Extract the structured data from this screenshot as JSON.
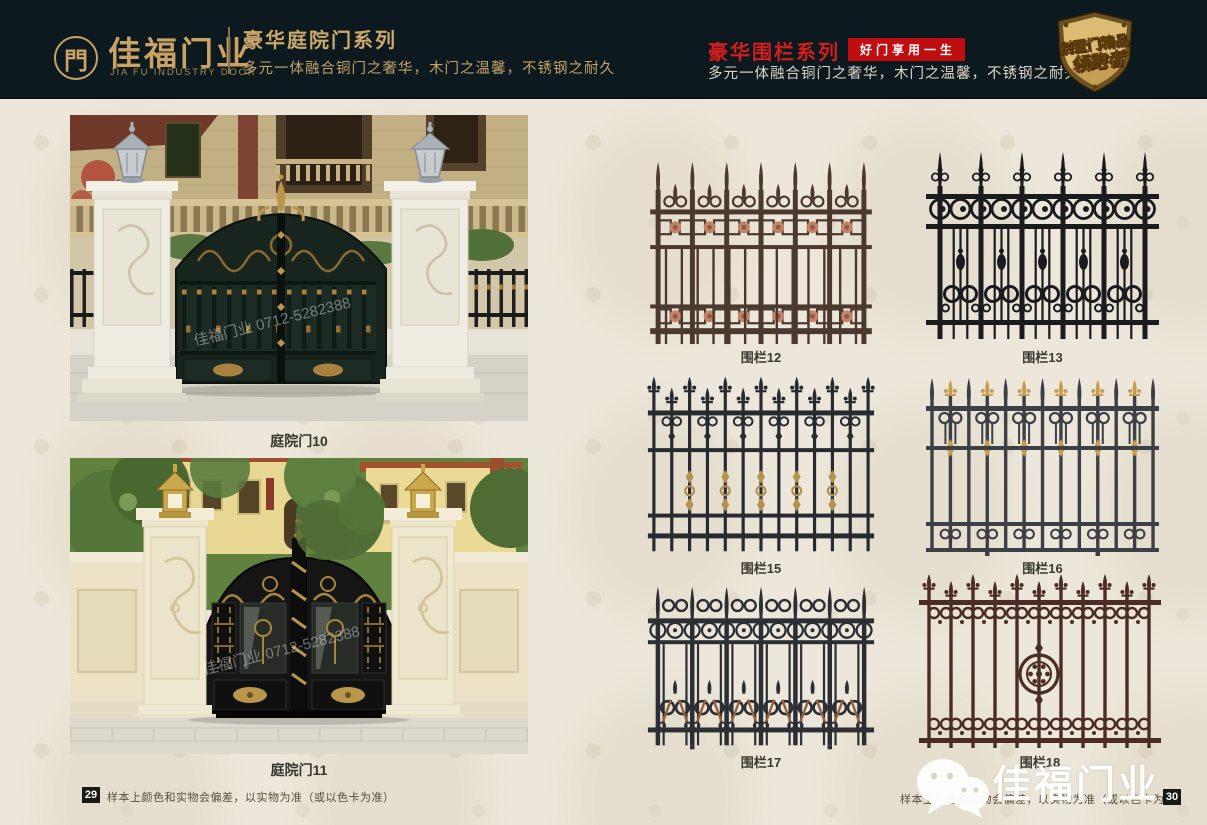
{
  "header": {
    "brand": {
      "logo_glyph": "門",
      "name": "佳福门业",
      "name_en": "JIA FU INDUSTRY DOOR"
    },
    "door_series": {
      "title": "豪华庭院门系列",
      "subtitle": "多元一体融合铜门之奢华，木门之温馨，不锈钢之耐久"
    },
    "fence_series": {
      "title": "豪华围栏系列",
      "badge": "好门享用一生",
      "subtitle": "多元一体融合铜门之奢华，木门之温馨，不锈钢之耐久"
    },
    "medal": {
      "line1": "别墅门精品",
      "line2": "领跑者"
    }
  },
  "products": {
    "gates": [
      {
        "label": "庭院门10"
      },
      {
        "label": "庭院门11"
      }
    ],
    "fences": [
      {
        "label": "围栏12"
      },
      {
        "label": "围栏13"
      },
      {
        "label": "围栏15"
      },
      {
        "label": "围栏16"
      },
      {
        "label": "围栏17"
      },
      {
        "label": "围栏18"
      }
    ]
  },
  "footer": {
    "left_page": "29",
    "right_page": "30",
    "disclaimer": "样本上颜色和实物会偏差，以实物为准（或以色卡为准）"
  },
  "watermark": {
    "brand": "佳福门业",
    "photo_phone": "佳福门业 0712-5282388"
  },
  "colors": {
    "header_bg": "#0c1a20",
    "gold": "#c9a264",
    "red": "#c00d10"
  }
}
